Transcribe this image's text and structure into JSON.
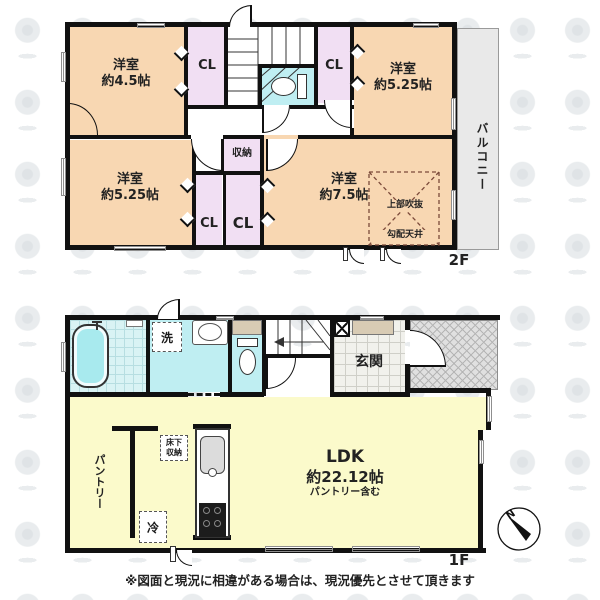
{
  "colors": {
    "wall": "#111111",
    "room_peach": "#f8d7b2",
    "closet_purple": "#f1dff3",
    "wet_cyan": "#bfeef2",
    "tile_cyan": "#d9f3f4",
    "ldk_yellow": "#fbfacb",
    "balcony_gray": "#e9e9e9",
    "porch_gray": "#e0e0e0",
    "cabinet_tan": "#d8cbb4",
    "void_brown": "#7b4a3a",
    "tub_cyan": "#a8eaee",
    "gray_win": "#8f8f8f"
  },
  "second_floor": {
    "floor_label": "2F",
    "balcony": "バルコニー",
    "room_nw": {
      "name": "洋室",
      "size": "約4.5帖"
    },
    "room_ne": {
      "name": "洋室",
      "size": "約5.25帖"
    },
    "room_sw": {
      "name": "洋室",
      "size": "約5.25帖"
    },
    "room_se": {
      "name": "洋室",
      "size": "約7.5帖"
    },
    "closet_nw": "CL",
    "closet_ne": "CL",
    "closet_mid_left": "CL",
    "closet_mid_right": "CL",
    "storage": "収納",
    "void_label": "上部吹抜",
    "sloped_ceiling": "勾配天井"
  },
  "first_floor": {
    "floor_label": "1F",
    "entrance": "玄関",
    "washer": "洗",
    "ldk": {
      "name": "LDK",
      "size": "約22.12帖",
      "note": "パントリー含む"
    },
    "pantry": "パントリー",
    "underfloor_storage": {
      "line1": "床下",
      "line2": "収納"
    },
    "refrigerator": "冷"
  },
  "compass": {
    "north": "N"
  },
  "footer": {
    "disclaimer": "※図面と現況に相違がある場合は、現況優先とさせて頂きます"
  }
}
